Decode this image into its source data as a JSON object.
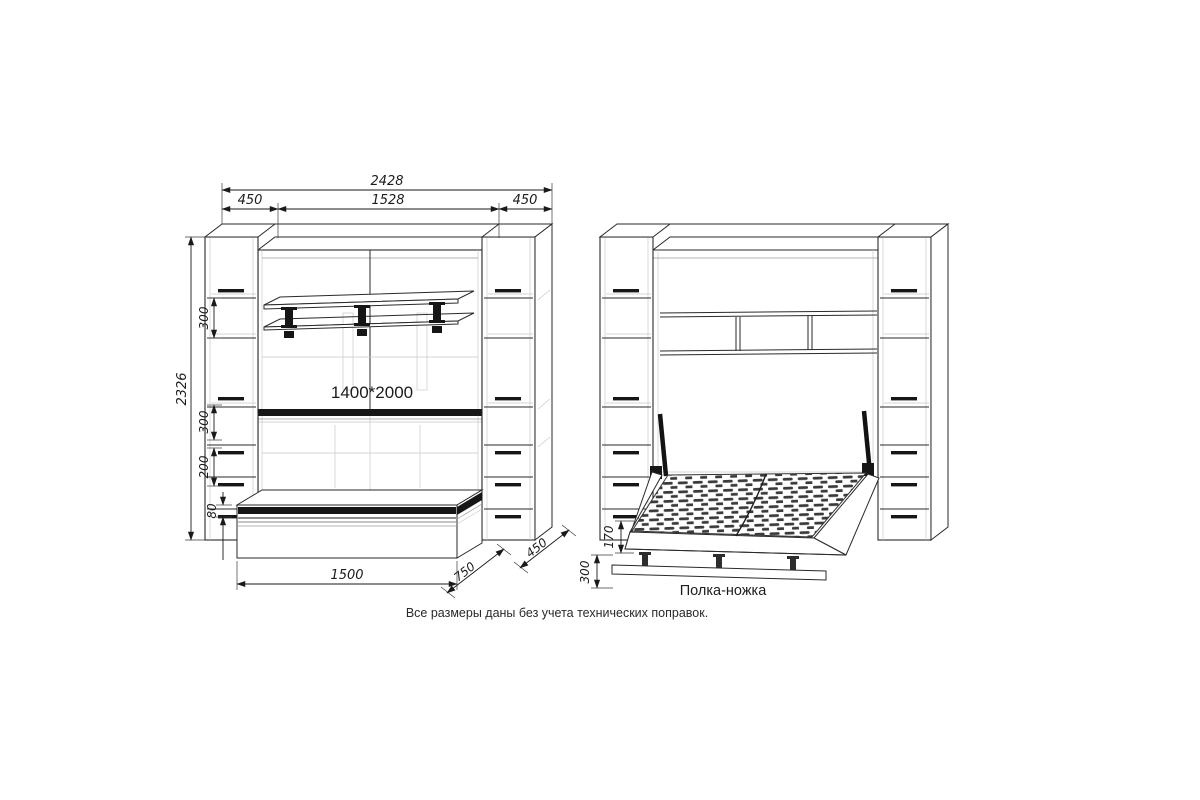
{
  "colors": {
    "ink": "#2a2a2a",
    "background": "#ffffff"
  },
  "caption": "Все размеры даны без учета технических поправок.",
  "closed_view": {
    "bed_size_label": "1400*2000",
    "dims": {
      "total_width": "2428",
      "left_cabinet_width": "450",
      "center_width": "1528",
      "right_cabinet_width": "450",
      "total_height": "2326",
      "shelf_gap_upper": "300",
      "shelf_gap_lower": "300",
      "drawer_block_height": "200",
      "plinth_height": "80",
      "base_length": "1500",
      "bed_depth": "750",
      "cabinet_depth": "450"
    }
  },
  "open_view": {
    "leg_shelf_label": "Полка-ножка",
    "dims": {
      "frame_height": "170",
      "leg_height": "300"
    }
  }
}
